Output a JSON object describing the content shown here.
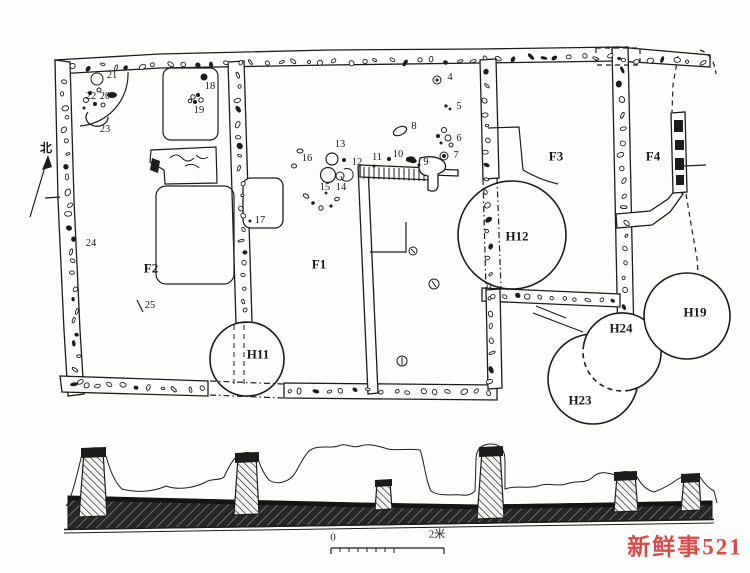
{
  "figure": {
    "type": "archaeological site plan with cross-section",
    "north_label": "北",
    "plan": {
      "rooms": [
        {
          "id": "F2",
          "x": 151,
          "y": 268
        },
        {
          "id": "F1",
          "x": 319,
          "y": 264
        },
        {
          "id": "F3",
          "x": 556,
          "y": 156
        },
        {
          "id": "F4",
          "x": 653,
          "y": 156
        }
      ],
      "pits": [
        {
          "id": "H11",
          "x": 258,
          "y": 354
        },
        {
          "id": "H12",
          "x": 517,
          "y": 236
        },
        {
          "id": "H19",
          "x": 695,
          "y": 312
        },
        {
          "id": "H24",
          "x": 621,
          "y": 328
        },
        {
          "id": "H23",
          "x": 580,
          "y": 400
        }
      ],
      "finds": [
        {
          "n": "4",
          "x": 450,
          "y": 78
        },
        {
          "n": "5",
          "x": 459,
          "y": 107
        },
        {
          "n": "6",
          "x": 459,
          "y": 139
        },
        {
          "n": "7",
          "x": 456,
          "y": 156
        },
        {
          "n": "8",
          "x": 414,
          "y": 127
        },
        {
          "n": "9",
          "x": 426,
          "y": 163
        },
        {
          "n": "10",
          "x": 398,
          "y": 155
        },
        {
          "n": "11",
          "x": 377,
          "y": 158
        },
        {
          "n": "12",
          "x": 357,
          "y": 163
        },
        {
          "n": "13",
          "x": 340,
          "y": 145
        },
        {
          "n": "14",
          "x": 341,
          "y": 188
        },
        {
          "n": "15",
          "x": 325,
          "y": 188
        },
        {
          "n": "16",
          "x": 307,
          "y": 159
        },
        {
          "n": "17",
          "x": 260,
          "y": 221
        },
        {
          "n": "18",
          "x": 210,
          "y": 87
        },
        {
          "n": "19",
          "x": 199,
          "y": 111
        },
        {
          "n": "20",
          "x": 105,
          "y": 97
        },
        {
          "n": "21",
          "x": 112,
          "y": 76
        },
        {
          "n": "22",
          "x": 91,
          "y": 97
        },
        {
          "n": "23",
          "x": 105,
          "y": 130
        },
        {
          "n": "24",
          "x": 91,
          "y": 244
        },
        {
          "n": "25",
          "x": 150,
          "y": 306
        }
      ]
    },
    "scale_bar": {
      "zero": "0",
      "max": "2米"
    },
    "watermark": {
      "text": "新鲜事521",
      "color": "#d94b4b"
    }
  }
}
